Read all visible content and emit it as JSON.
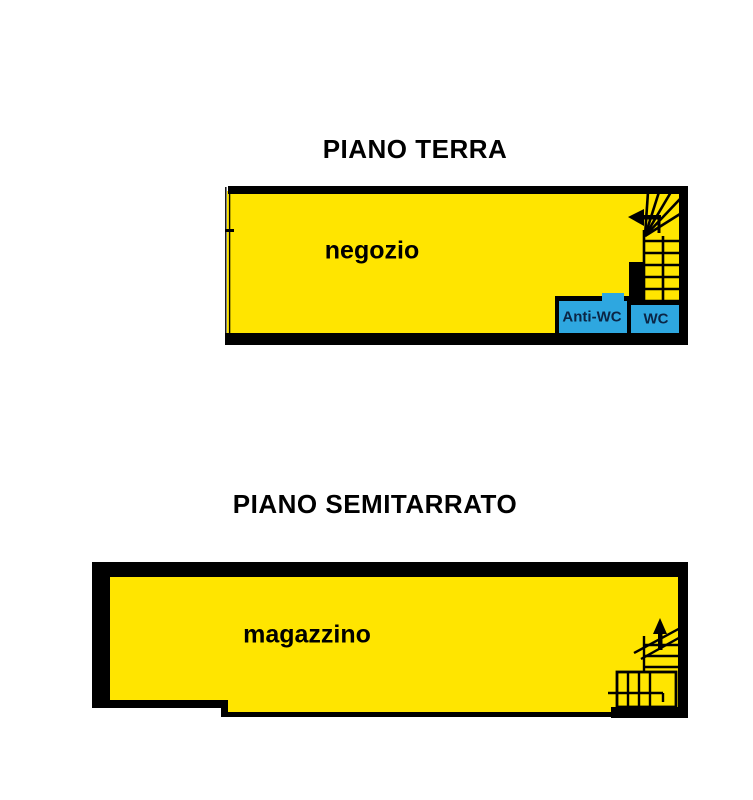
{
  "document": {
    "type": "floor-plan",
    "background": "#ffffff"
  },
  "colors": {
    "room_fill_yellow": "#ffe500",
    "wet_room_fill_blue": "#2ea7e0",
    "wall_black": "#000000",
    "wet_room_text": "#0b2545",
    "title_text": "#000000"
  },
  "floors": {
    "ground": {
      "title": "PIANO TERRA",
      "rooms": {
        "negozio": {
          "label": "negozio"
        },
        "anti_wc": {
          "label": "Anti-WC"
        },
        "wc": {
          "label": "WC"
        }
      },
      "features": [
        "storefront-glass-wall",
        "winder-staircase",
        "stair-direction-arrow-left"
      ]
    },
    "basement": {
      "title": "PIANO SEMITARRATO",
      "rooms": {
        "magazzino": {
          "label": "magazzino"
        }
      },
      "features": [
        "winder-staircase",
        "stair-direction-arrow-up"
      ]
    }
  }
}
